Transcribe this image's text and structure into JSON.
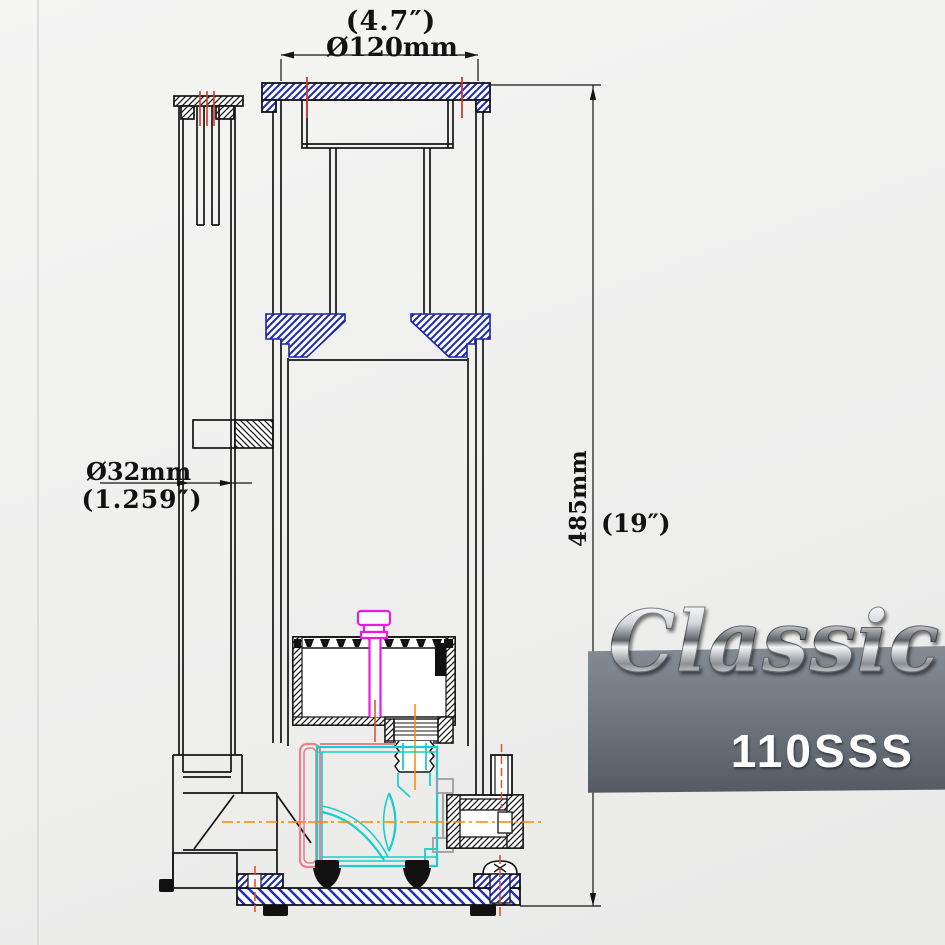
{
  "drawing": {
    "title": "protein skimmer sectional drawing",
    "dimensions": {
      "top_diameter": {
        "inches": "(4.7″)",
        "metric": "Ø120mm"
      },
      "left_diameter": {
        "metric": "Ø32mm",
        "inches": "(1.259″)"
      },
      "right_height": {
        "metric": "485mm",
        "inches": "(19″)"
      }
    }
  },
  "logo": {
    "script": "Classic",
    "model": "110SSS"
  },
  "colors": {
    "hatch_blue": "#2230b4",
    "hatch_black": "#1a1a1a",
    "pump_cyan": "#19cec8",
    "air_magenta": "#e81ae8",
    "bracket_pink": "#e8808f",
    "centerline_orange": "#ff8800",
    "tick_red": "#d43a2a",
    "badge_top": "#8f969e",
    "badge_bottom": "#51575f"
  }
}
